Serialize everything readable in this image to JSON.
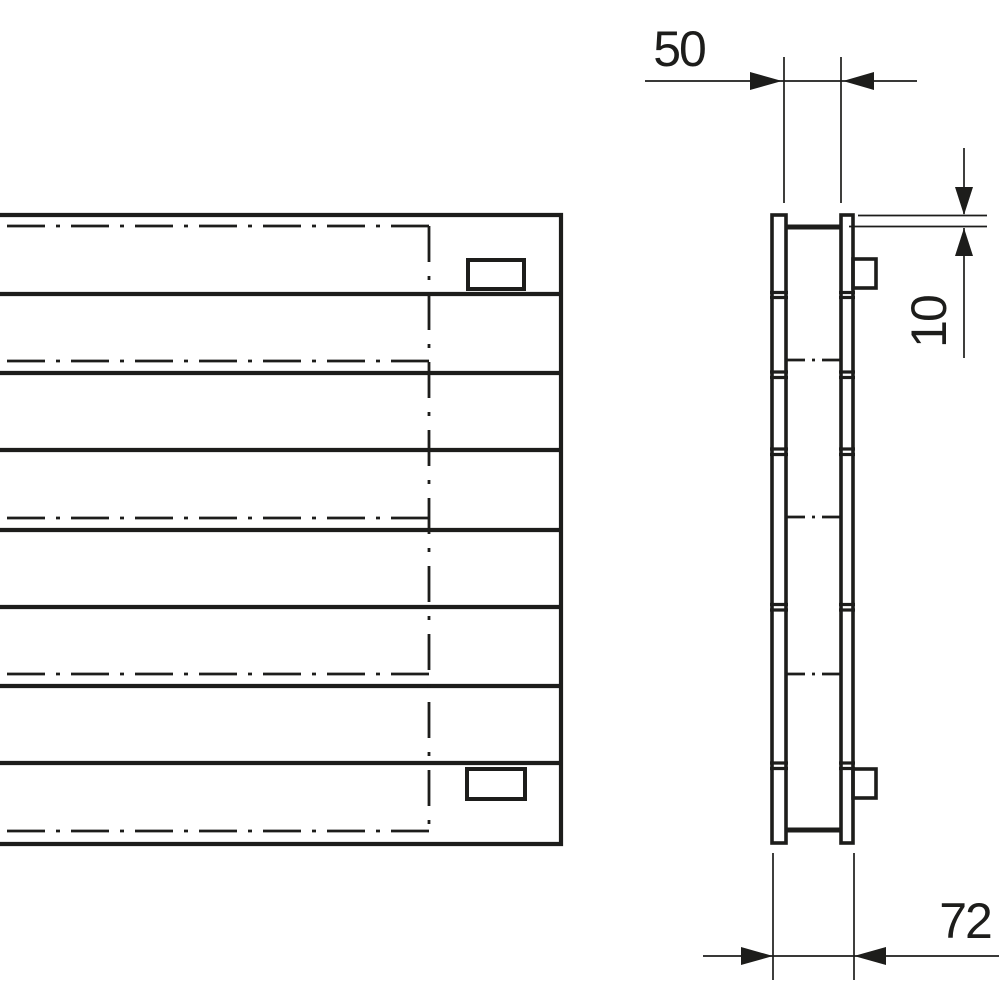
{
  "drawing": {
    "title": "radiator-two-view-technical-drawing",
    "dimensions": {
      "top_width": "50",
      "panel_offset": "10",
      "depth": "72"
    },
    "colors": {
      "line": "#1d1d1b",
      "background": "#ffffff"
    }
  }
}
